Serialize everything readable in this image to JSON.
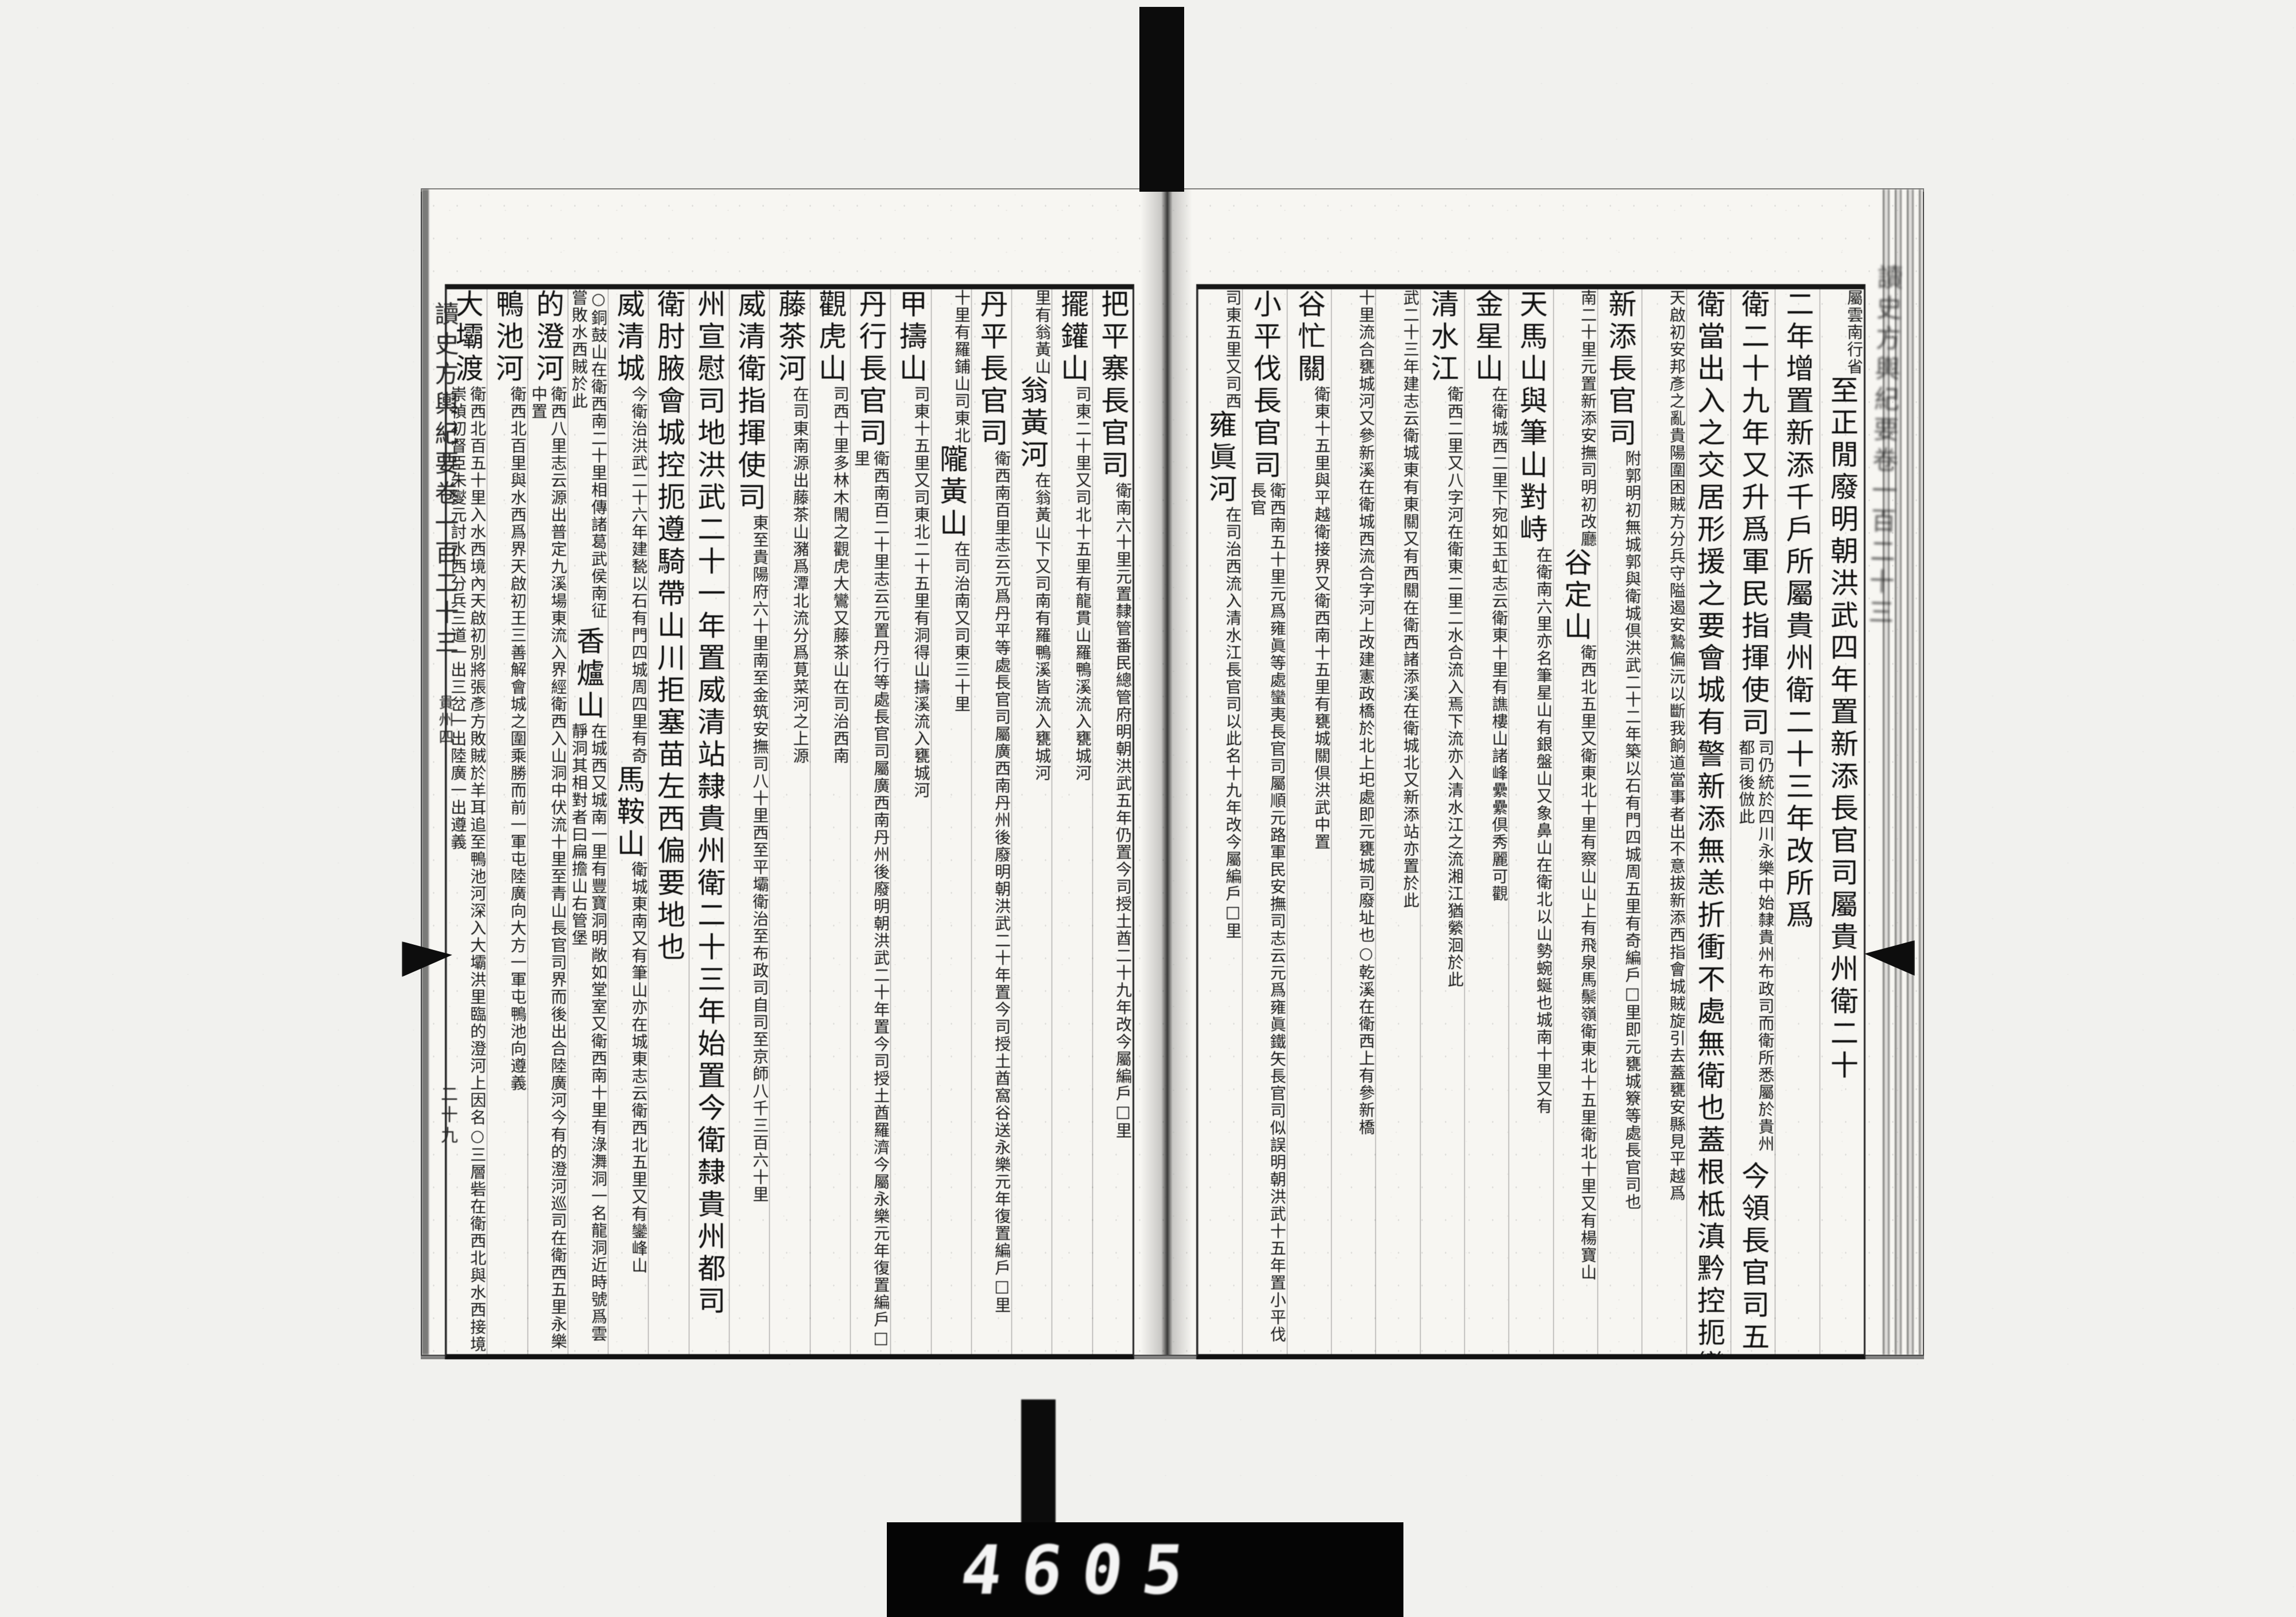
{
  "book": {
    "title": "讀史方輿紀要",
    "volume": "卷一百二十三",
    "section": "貴州四",
    "page_number": "二十九",
    "edge_title": "讀史方輿紀要卷一百二十三"
  },
  "counter": {
    "digits": "4605"
  },
  "right_page": {
    "columns": [
      {
        "segments": [
          {
            "size": "small",
            "text": "屬雲南行省"
          },
          {
            "size": "big",
            "text": "至正閒廢明朝洪武四年置新添長官司屬貴州衛二十"
          }
        ]
      },
      {
        "segments": [
          {
            "size": "big",
            "text": "二年增置新添千戶所屬貴州衛二十三年改所爲"
          }
        ]
      },
      {
        "segments": [
          {
            "size": "big",
            "text": "衛二十九年又升爲軍民指揮使司"
          },
          {
            "size": "small",
            "text": "司仍統於四川永樂中始隸貴州布政司而衛所悉屬於貴州都司後倣此"
          },
          {
            "size": "big",
            "text": "今領長官司五"
          }
        ]
      },
      {
        "segments": [
          {
            "size": "big",
            "text": "衛當出入之交居形援之要會城有警新添無恙折衝不處無衛也蓋根柢滇黔控扼變左衛實居其上"
          }
        ]
      },
      {
        "segments": [
          {
            "size": "small",
            "text": "天啟初安邦彥之亂貴陽圍困賊方分兵守隘遏安鷙偏沅以斷我餉道當事者出不意拔新添西指會城賊旋引去蓋甕安縣見平越爲"
          }
        ]
      },
      {
        "segments": [
          {
            "size": "big",
            "text": "新添長官司"
          },
          {
            "size": "small",
            "text": "附郭明初無城郭與衛城倶洪武二十二年築以石有門四城周五里有奇編戶□里即元甕城簝等處長官司也"
          }
        ]
      },
      {
        "segments": [
          {
            "size": "small",
            "text": "南二十里元置新添安撫司明初改廳"
          },
          {
            "size": "big",
            "text": "谷定山"
          },
          {
            "size": "small",
            "text": "衛西北五里又衛東北十里有察山山上有飛泉馬鬃嶺衛東北十五里衛北十里又有楊寶山"
          }
        ]
      },
      {
        "segments": [
          {
            "size": "big",
            "text": "天馬山與筆山對峙"
          },
          {
            "size": "small",
            "text": "在衛南六里亦名筆星山有銀盤山又象鼻山在衛北以山勢蜿蜒也城南十里又有"
          }
        ]
      },
      {
        "segments": [
          {
            "size": "big",
            "text": "金星山"
          },
          {
            "size": "small",
            "text": "在衛城西二里下宛如玉虹志云衛東十里有譙樓山諸峰纍纍倶秀麗可觀"
          }
        ]
      },
      {
        "segments": [
          {
            "size": "big",
            "text": "清水江"
          },
          {
            "size": "small",
            "text": "衛西二里又八字河在衛東二里二水合流入焉下流亦入清水江之流湘江猶縈洄於此"
          }
        ]
      },
      {
        "segments": [
          {
            "size": "small",
            "text": "武二十三年建志云衛城東有東關又有西關在衛西諸添溪在衛城北又新添站亦置於此"
          }
        ]
      },
      {
        "segments": [
          {
            "size": "small",
            "text": "十里流合甕城河又參新溪在衛城西流合字河上改建憲政橋於北上圯處即元甕城司廢址也○乾溪在衛西上有參新橋"
          }
        ]
      },
      {
        "segments": [
          {
            "size": "big",
            "text": "谷忙關"
          },
          {
            "size": "small",
            "text": "衛東十五里與平越衛接界又衛西南十五里有甕城關倶洪武中置"
          }
        ]
      },
      {
        "segments": [
          {
            "size": "big",
            "text": "小平伐長官司"
          },
          {
            "size": "small",
            "text": "衛西南五十里元爲雍眞等處蠻夷長官司屬順元路軍民安撫司志云元爲雍眞鐵矢長官司似誤明朝洪武十五年置小平伐長官"
          }
        ]
      },
      {
        "segments": [
          {
            "size": "small",
            "text": "司東五里又司西"
          },
          {
            "size": "big",
            "text": "雍眞河"
          },
          {
            "size": "small",
            "text": "在司治西流入清水江長官司以此名十九年改今屬編戶□里"
          }
        ]
      }
    ]
  },
  "left_page": {
    "columns": [
      {
        "segments": [
          {
            "size": "big",
            "text": "把平寨長官司"
          },
          {
            "size": "small",
            "text": "衛南六十里元置隸管番民總管府明朝洪武五年仍置今司授土酋二十九年改今屬編戶□里"
          }
        ]
      },
      {
        "segments": [
          {
            "size": "big",
            "text": "擺鑵山"
          },
          {
            "size": "small",
            "text": "司東二十里又司北十五里有龍貫山羅鴨溪流入甕城河"
          }
        ]
      },
      {
        "segments": [
          {
            "size": "small",
            "text": "里有翁黃山"
          },
          {
            "size": "big",
            "text": "翁黃河"
          },
          {
            "size": "small",
            "text": "在翁黃山下又司南有羅鴨溪皆流入甕城河"
          }
        ]
      },
      {
        "segments": [
          {
            "size": "big",
            "text": "丹平長官司"
          },
          {
            "size": "small",
            "text": "衛西南百里志云元爲丹平等處長官司屬廣西南丹州後廢明朝洪武二十年置今司授土酋窩谷送永樂元年復置編戶□里"
          }
        ]
      },
      {
        "segments": [
          {
            "size": "small",
            "text": "十里有羅鋪山司東北"
          },
          {
            "size": "big",
            "text": "隴黃山"
          },
          {
            "size": "small",
            "text": "在司治南又司東三十里"
          }
        ]
      },
      {
        "segments": [
          {
            "size": "big",
            "text": "甲擣山"
          },
          {
            "size": "small",
            "text": "司東十五里又司東北二十五里有洞得山擣溪流入甕城河"
          }
        ]
      },
      {
        "segments": [
          {
            "size": "big",
            "text": "丹行長官司"
          },
          {
            "size": "small",
            "text": "衛西南百二十里志云元置丹行等處長官司屬廣西南丹州後廢明朝洪武二十年置今司授土酋羅濟今屬永樂元年復置編戶□里"
          }
        ]
      },
      {
        "segments": [
          {
            "size": "big",
            "text": "觀虎山"
          },
          {
            "size": "small",
            "text": "司西十里多林木閙之觀虎大鸞又藤茶山在司治西南"
          }
        ]
      },
      {
        "segments": [
          {
            "size": "big",
            "text": "藤茶河"
          },
          {
            "size": "small",
            "text": "在司東南源出藤茶山瀦爲潭北流分爲莧菜河之上源"
          }
        ]
      },
      {
        "segments": [
          {
            "size": "big",
            "text": "威清衛指揮使司"
          },
          {
            "size": "small",
            "text": "東至貴陽府六十里南至金筑安撫司八十里西至平壩衛治至布政司自司至京師八千三百六十里"
          }
        ]
      },
      {
        "segments": [
          {
            "size": "big",
            "text": "州宣慰司地洪武二十一年置威清站隸貴州衛二十三年始置今衛隸貴州都司"
          }
        ]
      },
      {
        "segments": [
          {
            "size": "big",
            "text": "衛肘腋會城控扼遵騎帶山川拒塞苗左西偏要地也"
          }
        ]
      },
      {
        "segments": [
          {
            "size": "big",
            "text": "威清城"
          },
          {
            "size": "small",
            "text": "今衛治洪武二十六年建甃以石有門四城周四里有奇"
          },
          {
            "size": "big",
            "text": "馬鞍山"
          },
          {
            "size": "small",
            "text": "衛城東南又有筆山亦在城東志云衛西北五里又有鑾峰山"
          }
        ]
      },
      {
        "segments": [
          {
            "size": "small",
            "text": "○銅鼓山在衛西南二十里相傳諸葛武侯南征嘗敗水西賊於此"
          },
          {
            "size": "big",
            "text": "香爐山"
          },
          {
            "size": "small",
            "text": "在城西又城南一里有豐寶洞明敞如堂室又衛西南十里有淥㵲洞一名龍洞近時號爲雲靜洞其相對者曰扁擔山右管堡"
          }
        ]
      },
      {
        "segments": [
          {
            "size": "big",
            "text": "的澄河"
          },
          {
            "size": "small",
            "text": "衛西八里志云源出普定九溪場東流入界經衛西入山洞中伏流十里至青山長官司界而後出合陸廣河今有的澄河巡司在衛西五里永樂中置"
          }
        ]
      },
      {
        "segments": [
          {
            "size": "big",
            "text": "鴨池河"
          },
          {
            "size": "small",
            "text": "衛西北百里與水西爲界天啟初王三善解會城之圍乘勝而前一軍屯陸廣向大方一軍屯鴨池向遵義"
          }
        ]
      },
      {
        "segments": [
          {
            "size": "big",
            "text": "大壩渡"
          },
          {
            "size": "small",
            "text": "衛西北百五十里入水西境內天啟初別將張彥方敗賊於羊耳追至鴨池河深入大壩洪里臨的澄河上因名○三層砦在衛西北與水西接境崇禎初督臣朱燮元討水西分兵三道一出三岔一出陸廣一出遵義"
          }
        ]
      }
    ]
  }
}
